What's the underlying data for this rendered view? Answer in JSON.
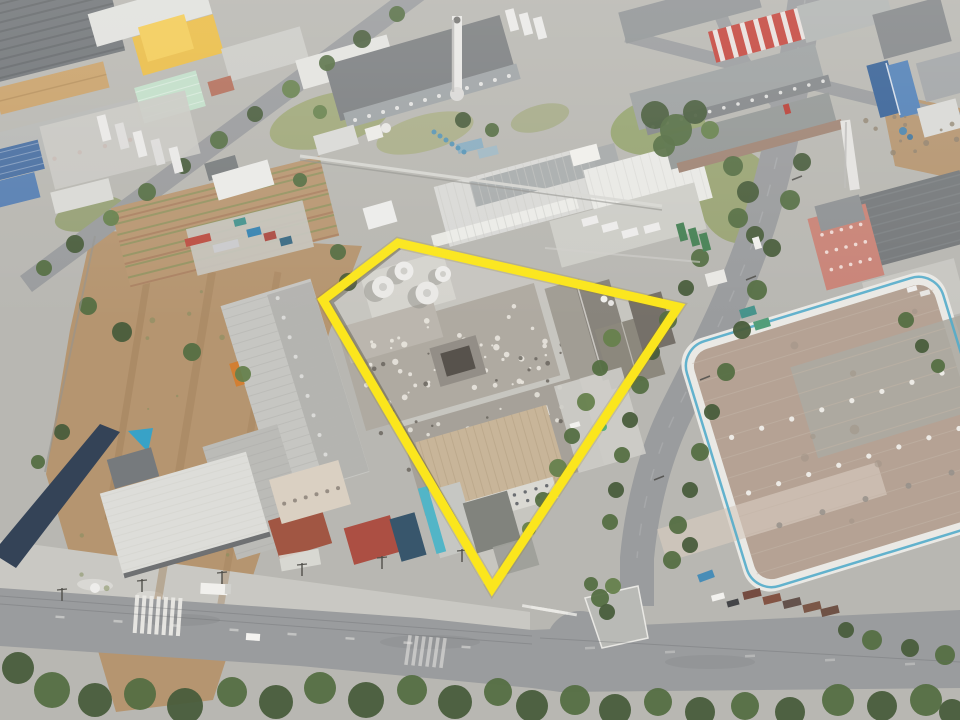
{
  "scene": {
    "kind": "aerial-drone-photograph",
    "subject": "Industrial district seen from above with one factory property outlined in yellow",
    "visible_text": "none",
    "lighting": "bright hazy daylight, shadows cast to lower-left"
  },
  "highlight": {
    "label": "property-boundary-outline",
    "shape": "quadrilateral",
    "points": "398,243 678,307 492,588 323,300",
    "stroke_color": "#FBE612",
    "stroke_width": 9
  },
  "palette": {
    "road": "#95989a",
    "concrete": "#c7c7c1",
    "concrete_bright": "#c5c4be",
    "dirt": "#b2916a",
    "grass": "#97a06e",
    "tree_dark": "#3f5533",
    "roof_main": "#aba79e",
    "roof_tan": "#c6b395",
    "roof_brown": "#b19f90",
    "roof_yellow": "#e9ba3e",
    "roof_red": "#c23f35",
    "roof_mint": "#bedec7",
    "blue_building": "#3f6da4",
    "wall_blue": "#2a3a50",
    "accent_teal": "#4aa9c9",
    "tank_white": "#e9e9e6"
  },
  "inventory": {
    "highlighted_property": [
      "four white storage tanks",
      "large speckled flat factory roof",
      "tan corrugated two-story building",
      "old gabled concrete building",
      "tree row along east fence"
    ],
    "storage_tanks": 4,
    "roads": [
      "diagonal street upper-left",
      "tree-lined avenue on right",
      "bottom boulevard with zebra crosswalk",
      "Y-intersection with planted traffic island"
    ],
    "notable_buildings": [
      "yellow-roof warehouse",
      "mint-green warehouse",
      "red-white striped factory roof",
      "blue gabled building",
      "huge brown-roof distribution warehouse with curved white wall and teal stripe",
      "truck depot with striped trailers",
      "navy perimeter wall",
      "white industrial chimneys"
    ]
  }
}
